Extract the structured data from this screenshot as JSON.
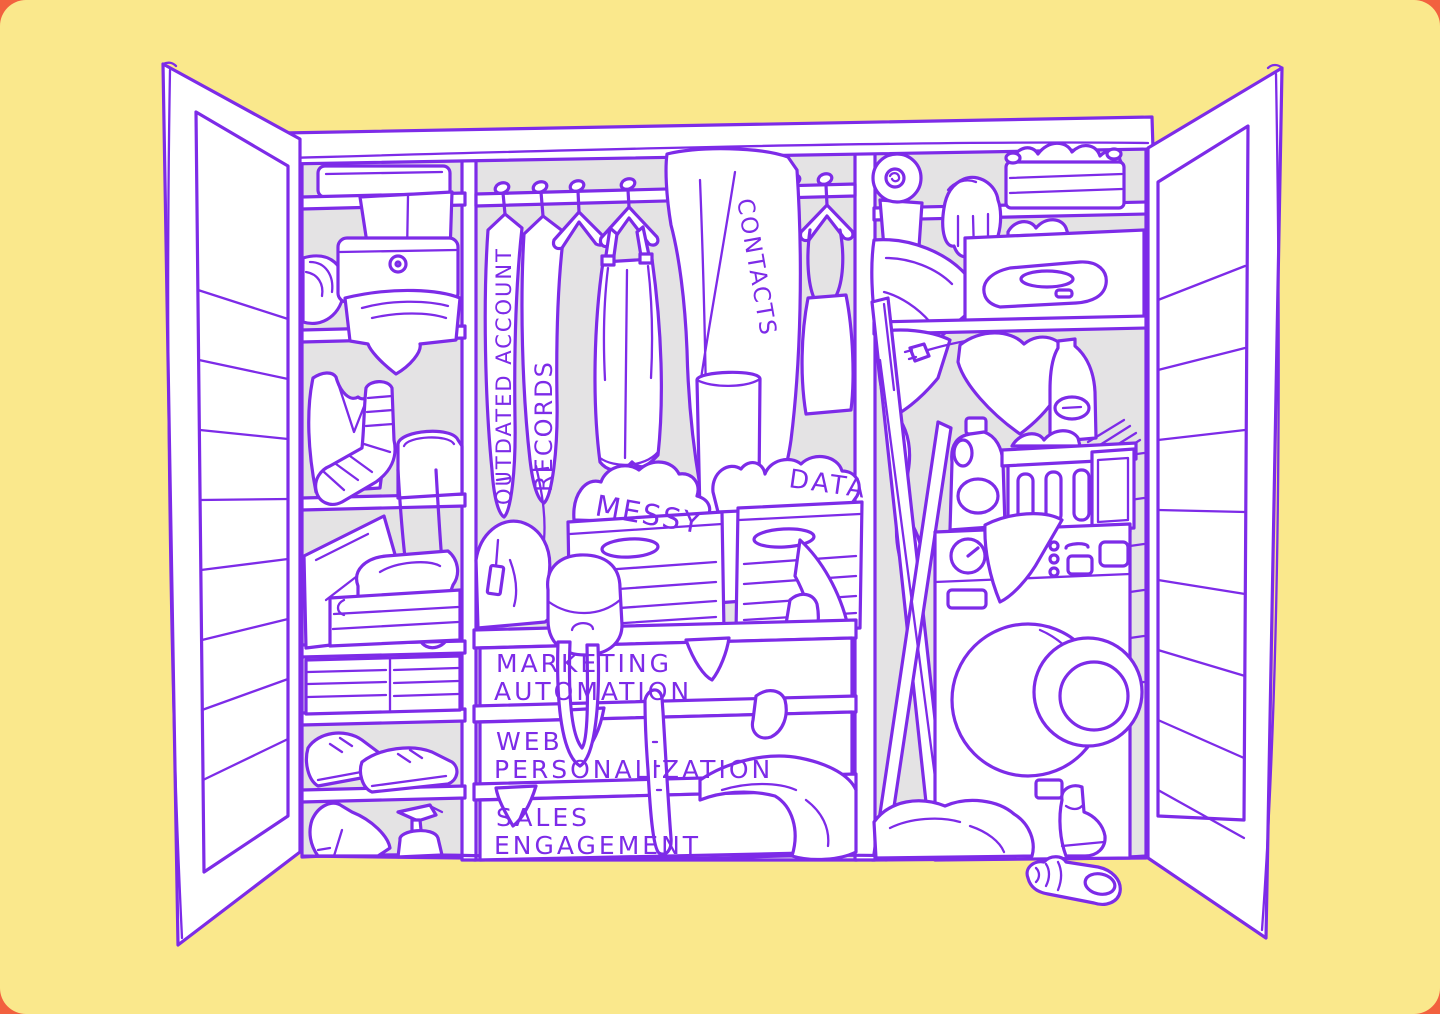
{
  "colors": {
    "backdrop": "#F2613F",
    "card": "#FAE88C",
    "line": "#7D2BE8",
    "interior": "#E4E3E4",
    "white": "#FFFFFF"
  },
  "closet": {
    "hanging_items": [
      {
        "label": "OUTDATED ACCOUNT"
      },
      {
        "label": "RECORDS"
      },
      {
        "label": "CONTACTS"
      }
    ],
    "boxes": [
      {
        "label": "MESSY"
      },
      {
        "label": "DATA"
      }
    ],
    "drawers": [
      {
        "line1": "MARKETING",
        "line2": "AUTOMATION"
      },
      {
        "line1": "WEB",
        "line2": "PERSONALIZATION"
      },
      {
        "line1": "SALES",
        "line2": "ENGAGEMENT"
      }
    ]
  }
}
